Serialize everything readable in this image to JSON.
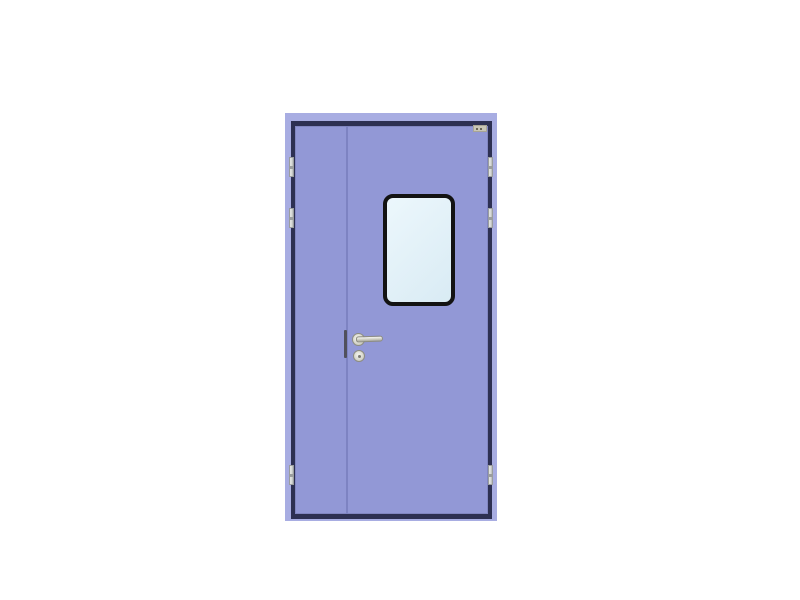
{
  "image": {
    "kind": "product-photo",
    "subject": "Unequal double-leaf cleanroom door, lavender finish, narrow inactive left leaf and wide active right leaf with rounded-corner vision window, lever handle, lock cylinder, six hinges and a small corner plate",
    "background_color": "#ffffff"
  },
  "door": {
    "leaf_count": 2,
    "leaves": [
      "inactive-narrow-left",
      "active-wide-right"
    ],
    "hinge_count": 6,
    "window": {
      "shape": "rounded-rectangle",
      "glazing": "clear"
    },
    "hardware": [
      "lever-handle",
      "handle-rose",
      "lock-cylinder",
      "edge-lock-strip",
      "corner-tag"
    ],
    "colors": {
      "background": "#ffffff",
      "frame": "#a8ade2",
      "frame_line": "#2d3052",
      "panel": "#9298d6",
      "panel_seam": "#7d83c2",
      "window_frame": "#131313",
      "glass_light": "#ecf7fc",
      "glass_shade": "#d9ebf4",
      "hinge_face": "#d6d9d6",
      "hinge_edge": "#9a9d9e",
      "hardware_metal": "#ccccc0",
      "hardware_edge": "#8d8d82",
      "lock_strip": "#50505c",
      "tag_face": "#c9c6b6",
      "tag_mark": "#6a6657"
    }
  }
}
